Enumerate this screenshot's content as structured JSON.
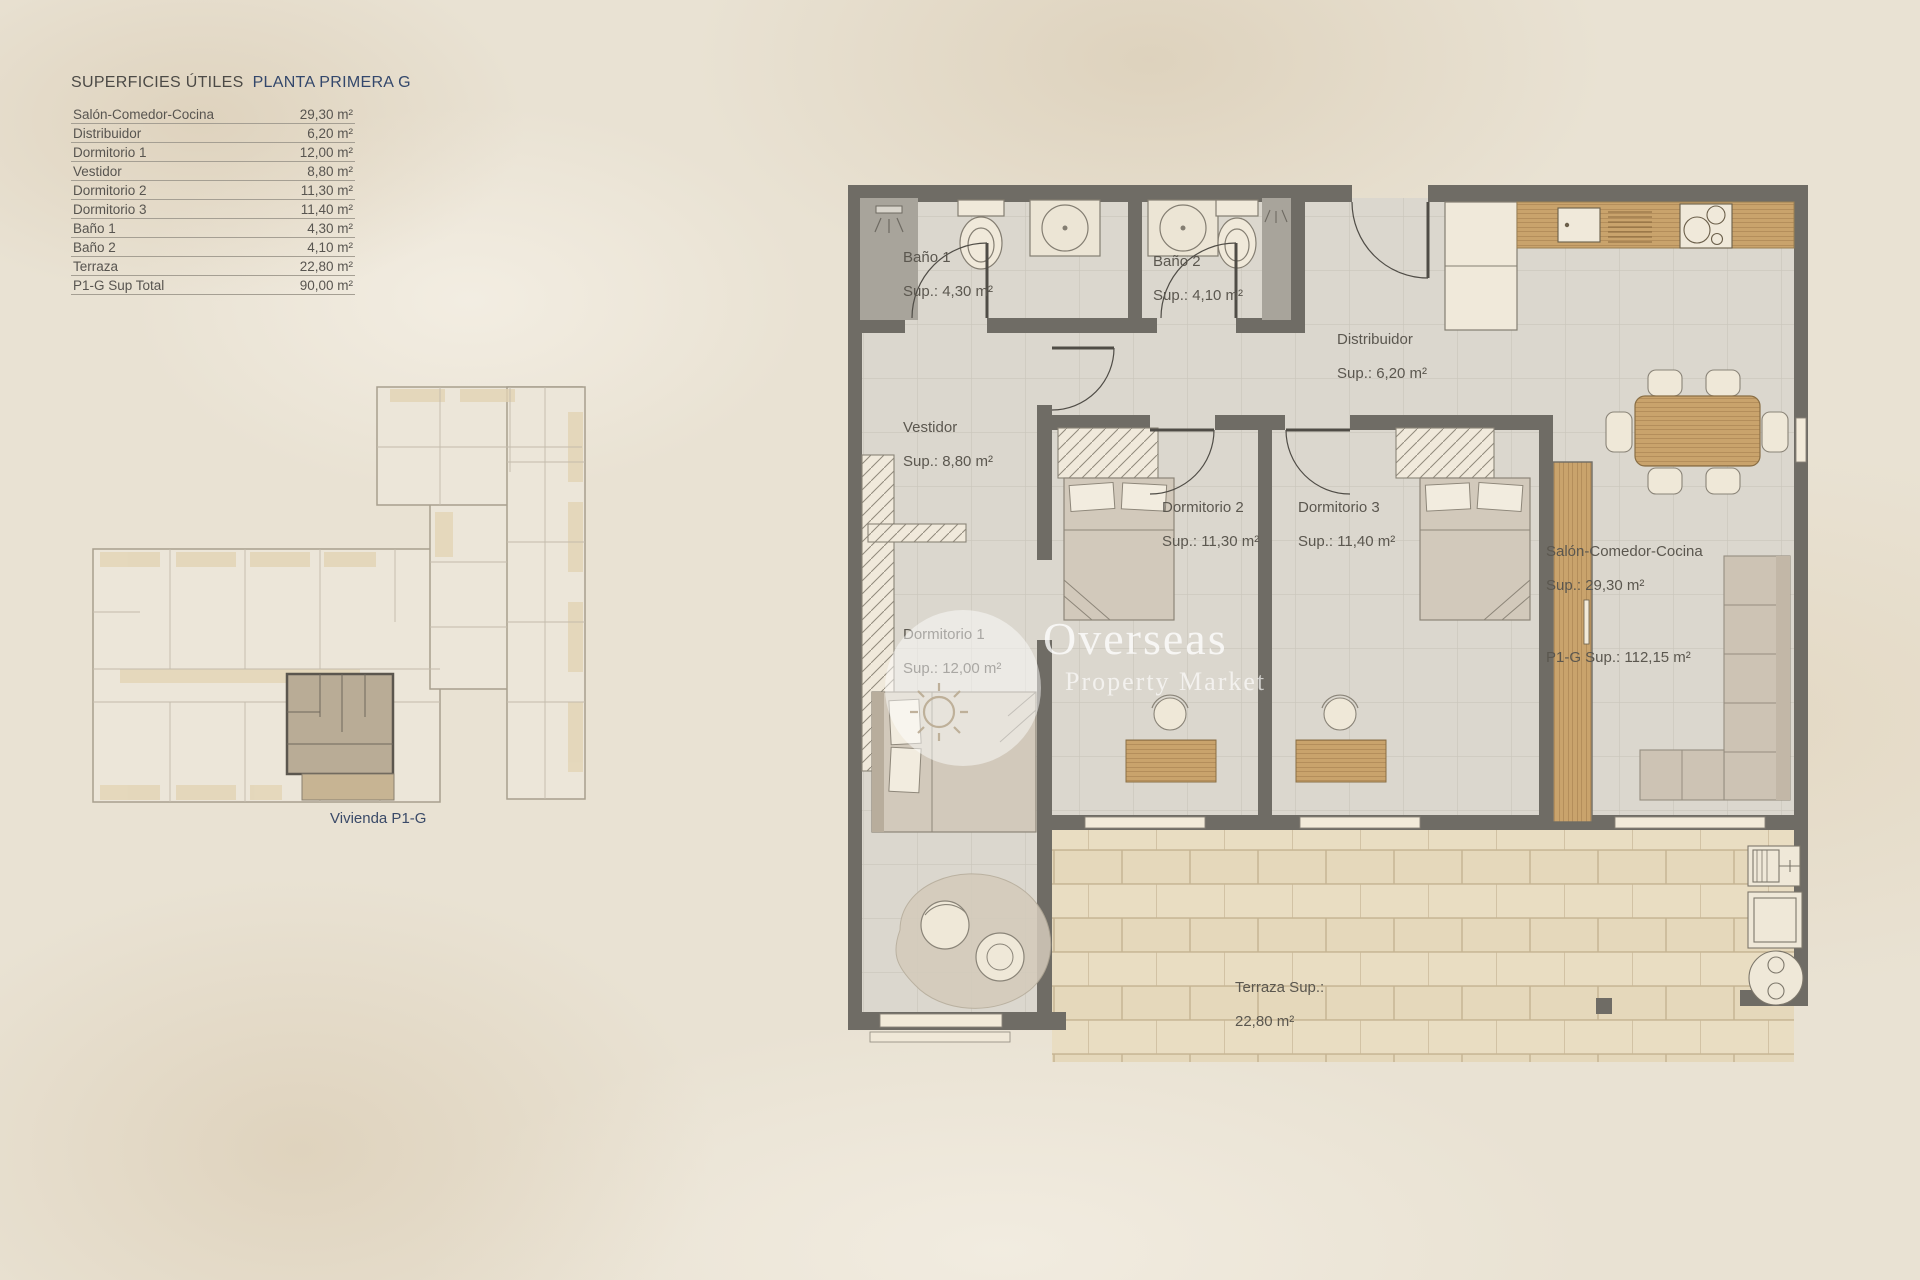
{
  "table": {
    "title": "SUPERFICIES ÚTILES",
    "subtitle": "PLANTA PRIMERA  G",
    "rows": [
      {
        "label": "Salón-Comedor-Cocina",
        "value": "29,30 m²"
      },
      {
        "label": "Distribuidor",
        "value": "6,20 m²"
      },
      {
        "label": "Dormitorio 1",
        "value": "12,00 m²"
      },
      {
        "label": "Vestidor",
        "value": "8,80 m²"
      },
      {
        "label": "Dormitorio 2",
        "value": "11,30 m²"
      },
      {
        "label": "Dormitorio 3",
        "value": "11,40 m²"
      },
      {
        "label": "Baño 1",
        "value": "4,30 m²"
      },
      {
        "label": "Baño 2",
        "value": "4,10 m²"
      },
      {
        "label": "Terraza",
        "value": "22,80 m²"
      },
      {
        "label": "P1-G Sup Total",
        "value": "90,00 m²"
      }
    ]
  },
  "overview": {
    "caption": "Vivienda P1-G"
  },
  "plan": {
    "labels": {
      "bano1": {
        "name": "Baño 1",
        "sup": "Sup.: 4,30  m²"
      },
      "bano2": {
        "name": "Baño 2",
        "sup": "Sup.: 4,10 m²"
      },
      "distribuidor": {
        "name": "Distribuidor",
        "sup": "Sup.: 6,20 m²"
      },
      "vestidor": {
        "name": "Vestidor",
        "sup": "Sup.: 8,80 m²"
      },
      "dorm1": {
        "name": "Dormitorio 1",
        "sup": "Sup.: 12,00 m²"
      },
      "dorm2": {
        "name": "Dormitorio 2",
        "sup": "Sup.: 11,30 m²"
      },
      "dorm3": {
        "name": "Dormitorio 3",
        "sup": "Sup.: 11,40 m²"
      },
      "salon": {
        "name": "Salón-Comedor-Cocina",
        "sup": "Sup.: 29,30 m²"
      },
      "total": {
        "name": "P1-G Sup.: 112,15 m²"
      },
      "terraza": {
        "name": "Terraza Sup.:",
        "sup": "22,80 m²"
      }
    }
  },
  "watermark": {
    "line1": "Overseas",
    "line2": "Property Market"
  },
  "colors": {
    "background": "#e9e2d3",
    "wall": "#6f6c65",
    "floor_tile": "#dbd7ce",
    "terrace_brick": "#e9ddc2",
    "wood": "#c9a36c",
    "accent_navy": "#33476b",
    "text_gray": "#585550",
    "highlight_unit": "#b9ac96",
    "watermark_white": "#ffffff"
  }
}
